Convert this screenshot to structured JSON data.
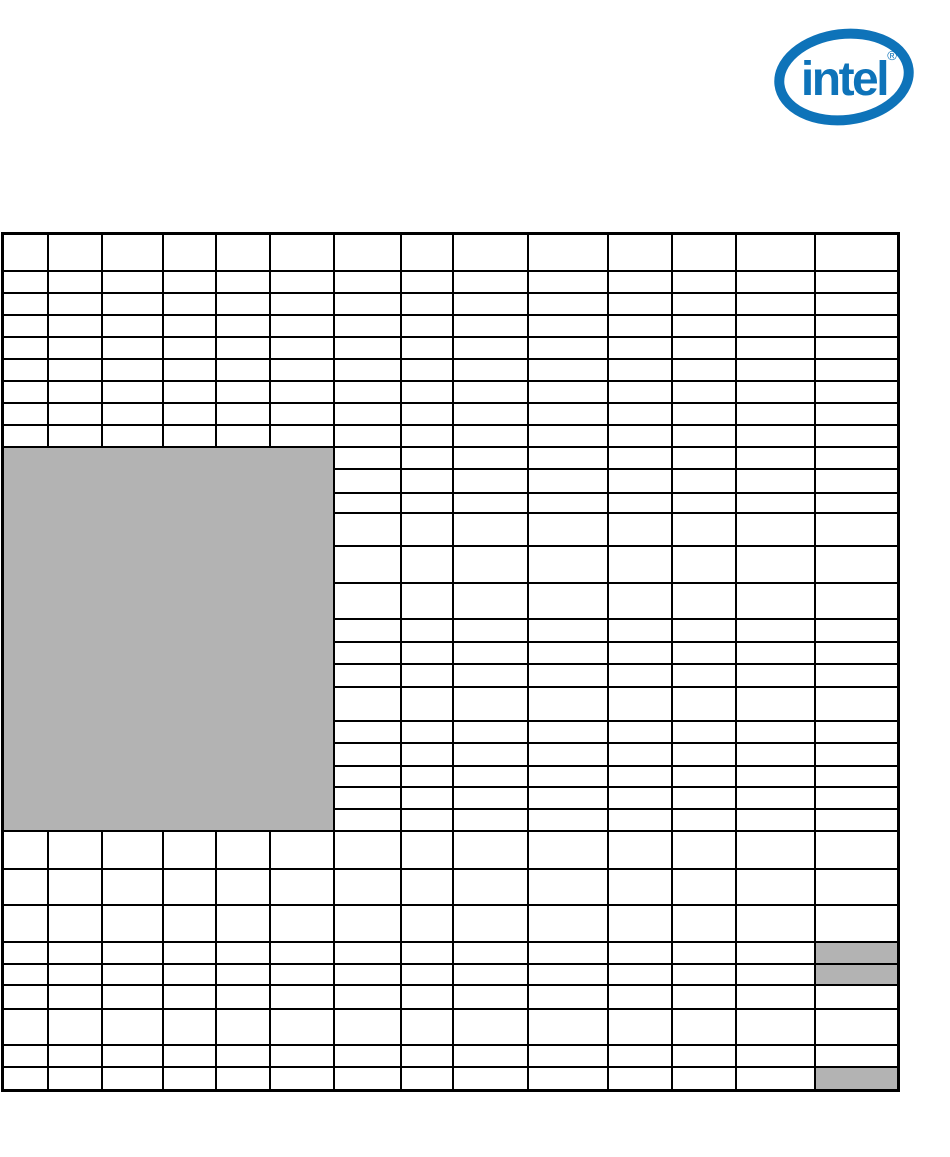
{
  "page": {
    "width_px": 950,
    "height_px": 1157,
    "background": "#ffffff"
  },
  "logo": {
    "brand_text": "intel",
    "registered_mark": "®",
    "color": "#0e73b9"
  },
  "table": {
    "border_color": "#000000",
    "cell_background": "#ffffff",
    "gray_fill": "#b3b3b3",
    "column_count": 14,
    "row_count": 33,
    "column_widths_px": [
      47,
      56,
      63,
      55,
      56,
      66,
      69,
      54,
      77,
      82,
      66,
      66,
      81,
      86
    ],
    "row_heights_px": [
      39,
      24,
      24,
      24,
      24,
      24,
      24,
      24,
      24,
      24,
      26,
      22,
      35,
      39,
      38,
      25,
      24,
      25,
      36,
      24,
      25,
      23,
      24,
      24,
      40,
      38,
      39,
      24,
      23,
      26,
      38,
      24,
      26
    ],
    "all_cells_empty": true,
    "gray_block": {
      "row_index": 9,
      "col_index": 0,
      "row_span": 15,
      "col_span": 6
    },
    "gray_cells": [
      {
        "row_index": 27,
        "col_index": 13
      },
      {
        "row_index": 28,
        "col_index": 13
      },
      {
        "row_index": 32,
        "col_index": 13
      }
    ]
  }
}
